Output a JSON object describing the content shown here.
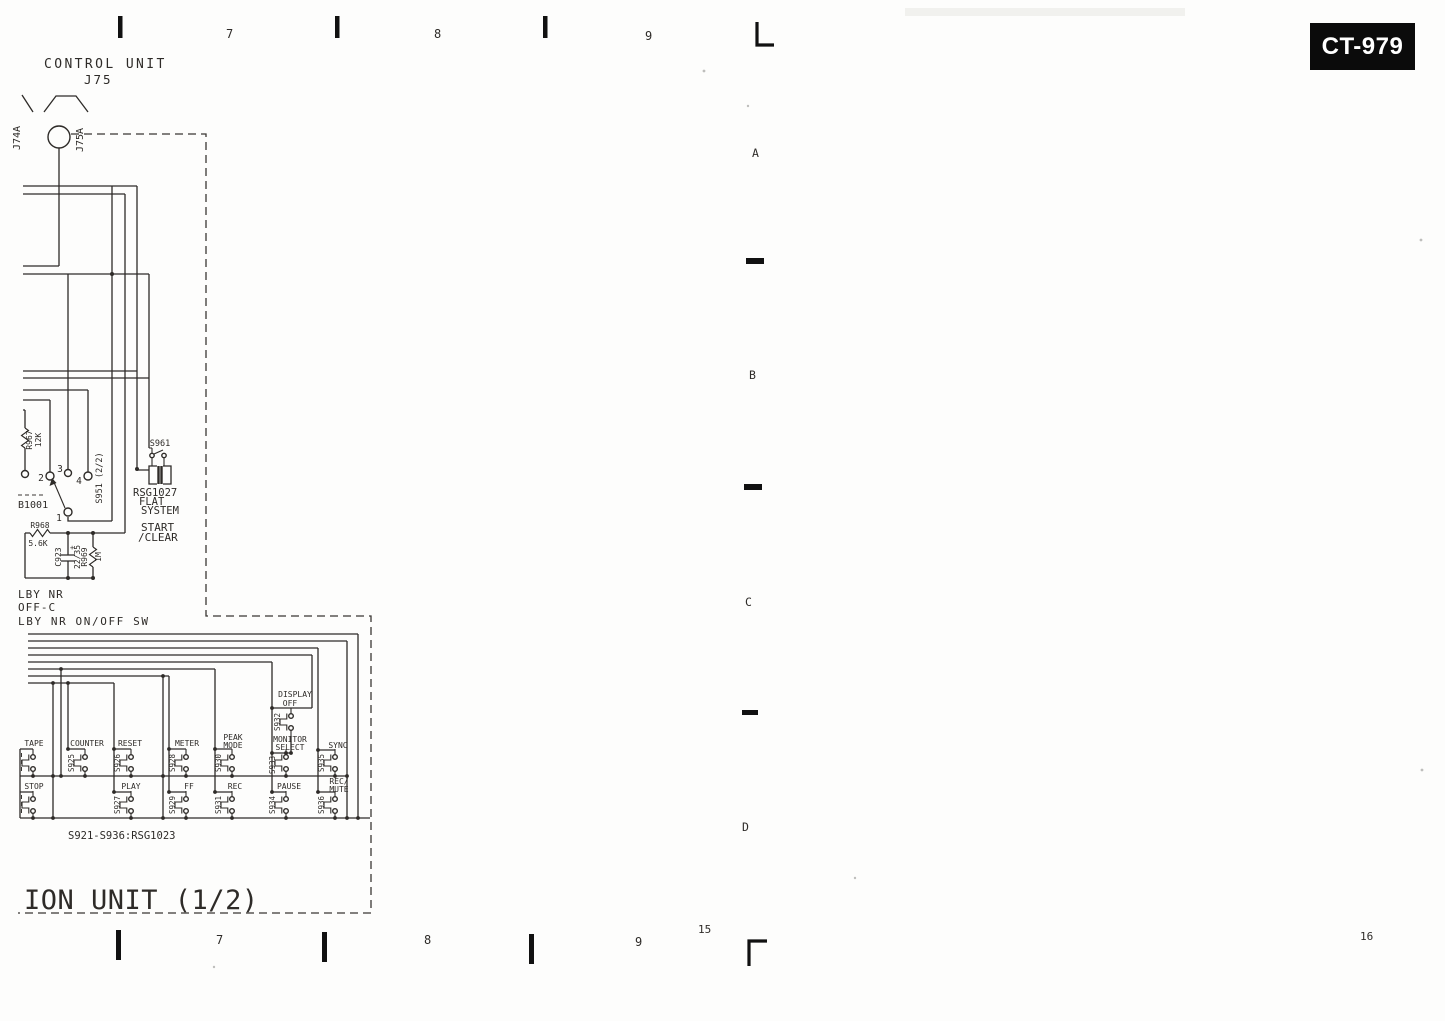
{
  "model_badge": "CT-979",
  "grid_refs": {
    "top": [
      "7",
      "8",
      "9"
    ],
    "bottom": [
      "7",
      "8",
      "9"
    ],
    "side": [
      "A",
      "B",
      "C",
      "D"
    ],
    "page_left": "15",
    "page_right": "16"
  },
  "control_unit": {
    "title": "CONTROL UNIT",
    "designator": "J75",
    "pin_left": "J74A",
    "pin_right": "J75A"
  },
  "components": {
    "r967": {
      "ref": "R967",
      "value": "12K"
    },
    "r968": {
      "ref": "R968",
      "value": "5.6K"
    },
    "r969": {
      "ref": "R969",
      "value": "1M"
    },
    "c923": {
      "ref": "C923",
      "value": "22/35",
      "polarity": "+"
    },
    "rotary": {
      "ref": "B1001",
      "switch": "S951 (2/2)",
      "pos1": "1",
      "pos2": "2",
      "pos3": "3",
      "pos4": "4"
    },
    "s961": {
      "ref": "S961",
      "system_ref": "RSG1027",
      "system_line1": "FLAT",
      "system_line2": "SYSTEM",
      "function_line1": "START",
      "function_line2": "/CLEAR"
    }
  },
  "dolby": {
    "line1": "LBY NR",
    "line2": "OFF-C",
    "line3": "LBY NR ON/OFF SW"
  },
  "matrix": {
    "note": "S921-S936:RSG1023",
    "row1": [
      {
        "ref": "",
        "label1": "TAPE",
        "label2": ""
      },
      {
        "ref": "S925",
        "label1": "COUNTER",
        "label2": ""
      },
      {
        "ref": "S926",
        "label1": "RESET",
        "label2": ""
      },
      {
        "ref": "S928",
        "label1": "METER",
        "label2": ""
      },
      {
        "ref": "S930",
        "label1": "PEAK",
        "label2": "MODE"
      },
      {
        "ref": "S933",
        "label1": "MONITOR",
        "label2": "SELECT"
      },
      {
        "ref": "S935",
        "label1": "SYNC",
        "label2": ""
      }
    ],
    "row2": [
      {
        "ref": "",
        "label1": "STOP",
        "label2": ""
      },
      {
        "ref": "S927",
        "label1": "PLAY",
        "label2": ""
      },
      {
        "ref": "S929",
        "label1": "FF",
        "label2": ""
      },
      {
        "ref": "S931",
        "label1": "REC",
        "label2": ""
      },
      {
        "ref": "S934",
        "label1": "PAUSE",
        "label2": ""
      },
      {
        "ref": "S936",
        "label1": "REC/",
        "label2": "MUTE"
      }
    ],
    "display_off": {
      "ref": "S932",
      "label1": "DISPLAY",
      "label2": "OFF"
    }
  },
  "unit_title": "ION UNIT (1/2)"
}
